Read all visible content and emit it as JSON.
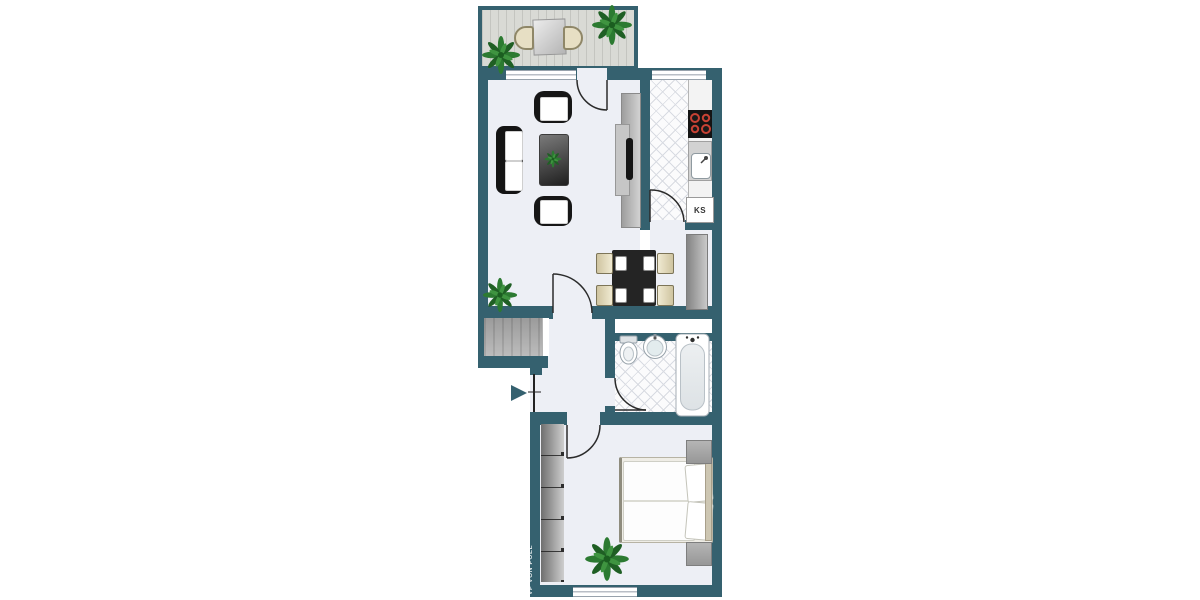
{
  "floorplan": {
    "labels": {
      "fridge": "KS"
    },
    "watermark": {
      "text": "VP VON POLL"
    },
    "colors": {
      "wall": "#35616F",
      "floor": "#EDEFF5",
      "tile-line": "#D8DBE2",
      "deck": "#D9DAD5",
      "deck-line": "#C4C5C0",
      "counter": "#F3F3F3",
      "furniture-dark": "#1C1C1C",
      "furniture-gray": "#A9A9A9",
      "chair-cream": "#E7DFC4",
      "plant-green": "#2E7D32",
      "burner-red": "#C84234",
      "door-line": "#2B2B2B"
    }
  }
}
